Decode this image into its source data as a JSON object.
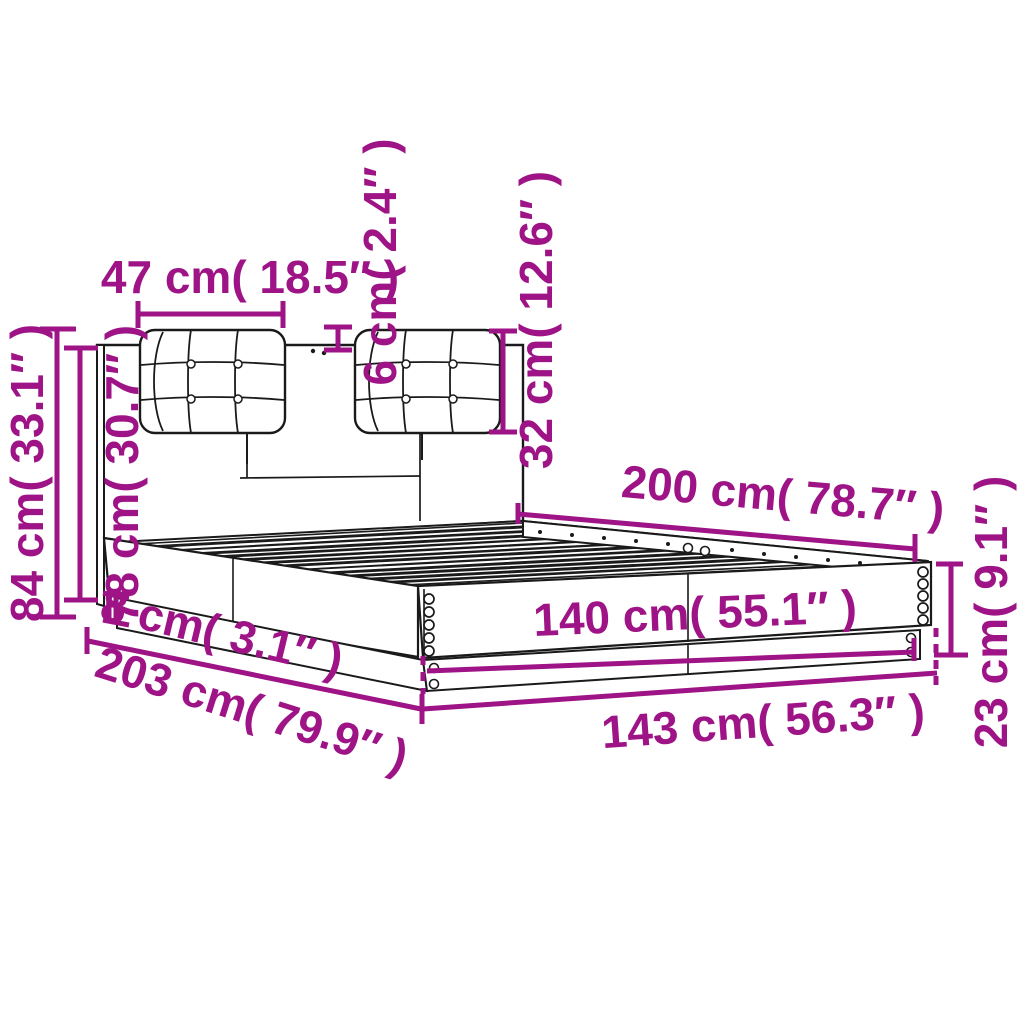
{
  "page": {
    "background": "#ffffff"
  },
  "diagram": {
    "subject": "bed-frame-with-headboard-and-cushions-dimension-diagram",
    "line_color": "#1a1a1a",
    "dimension_color": "#9E1386"
  },
  "dims": {
    "cushion_width": {
      "label": "47 cm( 18.5″ )",
      "cm": 47,
      "in": 18.5
    },
    "cushion_thickness": {
      "label": "6 cm( 2.4″ )",
      "cm": 6,
      "in": 2.4
    },
    "cushion_height": {
      "label": "32 cm( 12.6″ )",
      "cm": 32,
      "in": 12.6
    },
    "total_height": {
      "label": "84 cm( 33.1″ )",
      "cm": 84,
      "in": 33.1
    },
    "headboard_height": {
      "label": "78 cm( 30.7″ )",
      "cm": 78,
      "in": 30.7
    },
    "base_height": {
      "label": "8 cm( 3.1″ )",
      "cm": 8,
      "in": 3.1
    },
    "total_length": {
      "label": "203 cm( 79.9″ )",
      "cm": 203,
      "in": 79.9
    },
    "bed_length": {
      "label": "200 cm( 78.7″ )",
      "cm": 200,
      "in": 78.7
    },
    "inner_width": {
      "label": "140 cm( 55.1″ )",
      "cm": 140,
      "in": 55.1
    },
    "outer_width": {
      "label": "143 cm( 56.3″ )",
      "cm": 143,
      "in": 56.3
    },
    "rail_height": {
      "label": "23 cm( 9.1″ )",
      "cm": 23,
      "in": 9.1
    }
  }
}
